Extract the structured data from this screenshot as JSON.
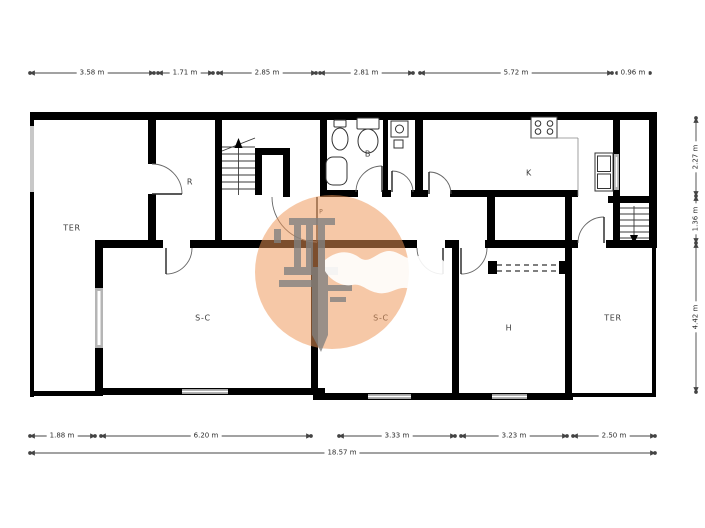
{
  "rooms": {
    "ter_left": "TER",
    "r": "R",
    "b": "B",
    "k": "K",
    "p": "P",
    "sc_left": "S-C",
    "sc_mid": "S-C",
    "h": "H",
    "ter_right": "TER"
  },
  "dimensions": {
    "top": [
      "3.58 m",
      "1.71 m",
      "2.85 m",
      "2.81 m",
      "5.72 m",
      "0.96 m"
    ],
    "right": [
      "2.27 m",
      "1.36 m",
      "4.42 m"
    ],
    "bottom": [
      "1.88 m",
      "6.20 m",
      "3.33 m",
      "3.23 m",
      "2.50 m"
    ],
    "overall": "18.57 m"
  },
  "colors": {
    "wall": "#000000",
    "dimension_line": "#444444",
    "window": "#b5b5b5",
    "watermark_circle": "#ee9557",
    "watermark_logo": "#808080"
  }
}
